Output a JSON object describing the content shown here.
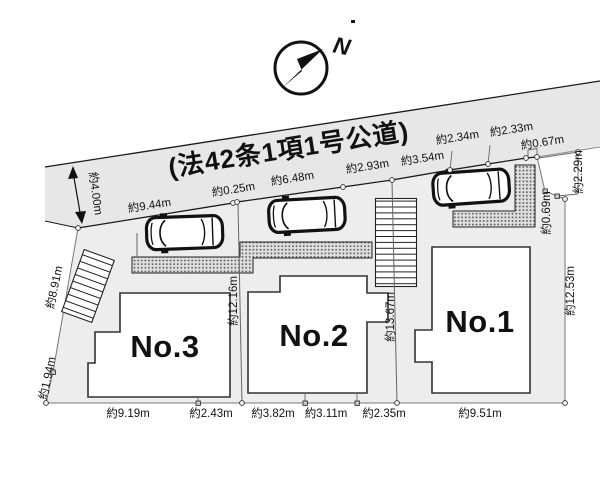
{
  "compass": {
    "north_label": "N"
  },
  "road": {
    "label": "(法42条1項1号公道)",
    "width_label": "約4.00m"
  },
  "lots": [
    {
      "label": "No.1"
    },
    {
      "label": "No.2"
    },
    {
      "label": "No.3"
    }
  ],
  "dims": {
    "road_frontage": [
      "約9.44m",
      "約0.25m",
      "約6.48m",
      "約2.93m",
      "約3.54m"
    ],
    "road_upper": [
      "約2.34m",
      "約2.33m",
      "約0.67m"
    ],
    "right": [
      "約2.29m",
      "約0.69m",
      "約12.53m"
    ],
    "left": [
      "約8.91m",
      "約1.94m"
    ],
    "interior": [
      "約12.16m",
      "約13.67m"
    ],
    "bottom": [
      "約9.19m",
      "約2.43m",
      "約3.82m",
      "約3.11m",
      "約2.35m",
      "約9.51m"
    ]
  },
  "colors": {
    "road_fill": "#e7e7e7",
    "lot_fill": "#ededed",
    "house_fill": "#ffffff",
    "outline": "#1a1a1a",
    "dim_line": "#666666"
  }
}
